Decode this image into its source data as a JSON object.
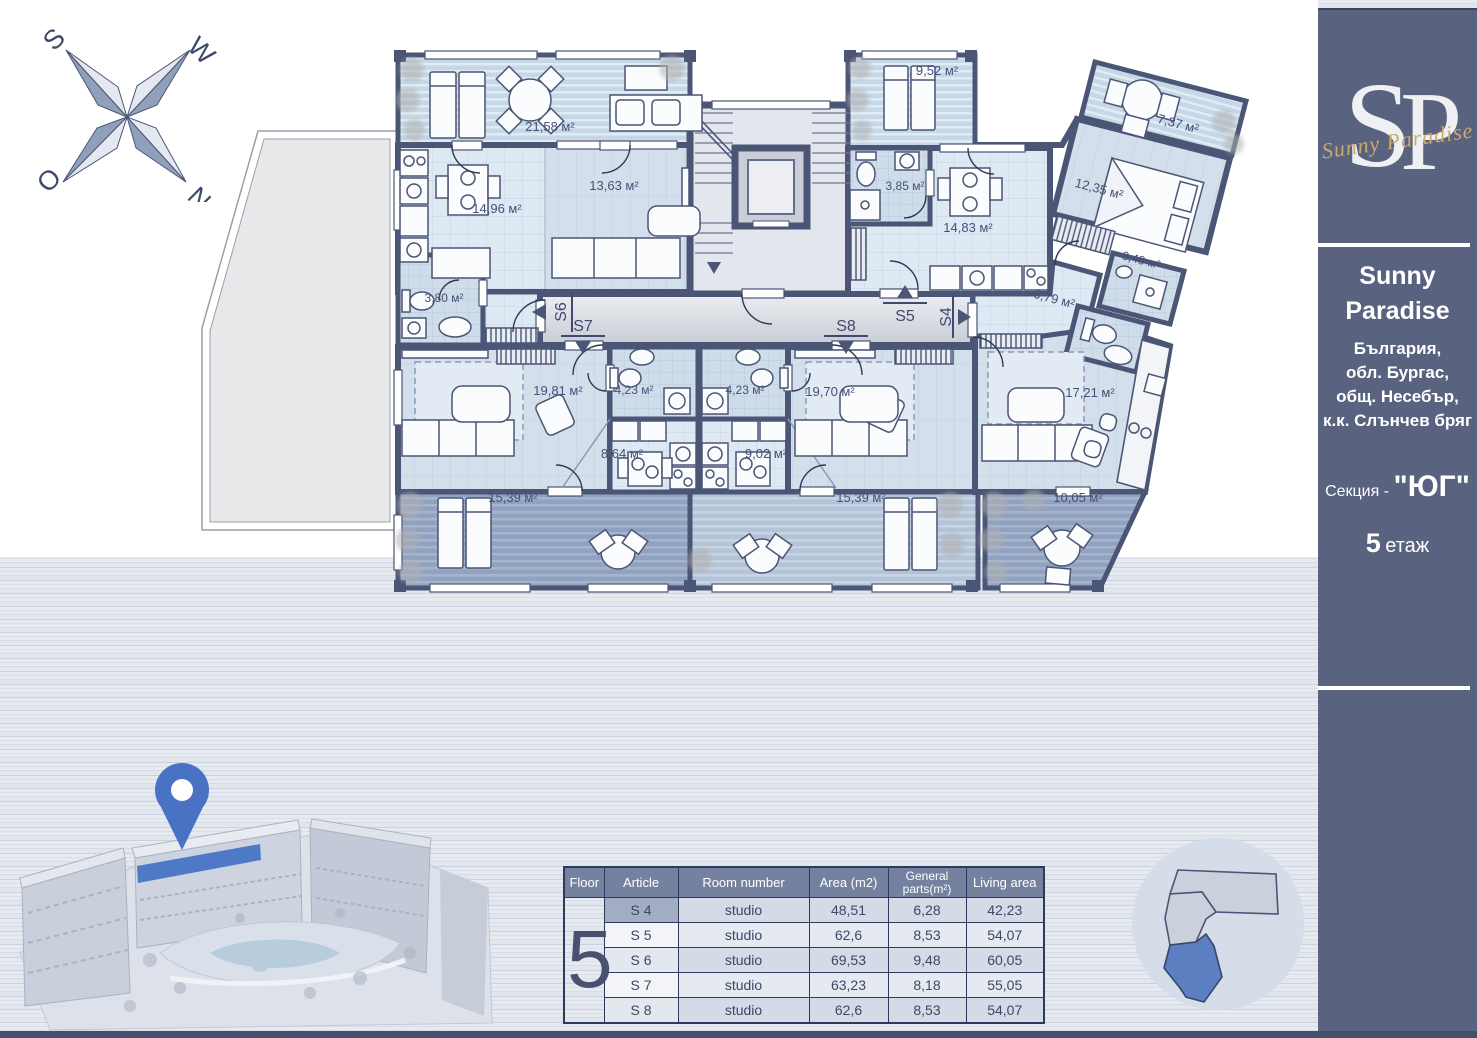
{
  "compass": {
    "s": "S",
    "w": "W",
    "o": "O",
    "n": "N"
  },
  "sidebar": {
    "logo": {
      "monogram_s": "S",
      "monogram_p": "P",
      "script": "Sunny Paradise"
    },
    "title_line1": "Sunny",
    "title_line2": "Paradise",
    "address_line1": "България,",
    "address_line2": "обл. Бургас,",
    "address_line3": "общ. Несебър,",
    "address_line4": "к.к. Слънчев бряг",
    "section_label": "Секция -",
    "section_value": "\"ЮГ\"",
    "floor_number": "5",
    "floor_word": "етаж"
  },
  "floorplan": {
    "rooms": {
      "terrace_s6": "21,58 м²",
      "kitchen_living_s6": "14,96 м²",
      "room_s6": "13,63 м²",
      "bath_s6": "3,80 м²",
      "terrace_s5": "9,52 м²",
      "bath_s5": "3,85 м²",
      "living_s5": "14,83 м²",
      "terrace_s4_top": "7,37 м²",
      "bedroom_s4": "12,35 м²",
      "bath_s4": "3,48 м²",
      "hall_s4": "6,79 м²",
      "living_s7": "19,81 м²",
      "bath_s7": "4,23 м²",
      "bath_s8": "4,23 м²",
      "living_s8": "19,70 м²",
      "kitchen_s7": "8,64 м²",
      "kitchen_s8": "9,02 м²",
      "living_s4": "17,21 м²",
      "terrace_s7": "15,39 м²",
      "terrace_s8": "15,39 м²",
      "terrace_s4_bottom": "10,05 м²"
    },
    "units": {
      "s4": "S4",
      "s5": "S5",
      "s6": "S6",
      "s7": "S7",
      "s8": "S8"
    }
  },
  "table": {
    "floor_header": "Floor",
    "floor_value": "5",
    "headers": [
      "Article",
      "Room number",
      "Area (m2)",
      "General parts(m²)",
      "Living area"
    ],
    "rows": [
      {
        "article": "S 4",
        "room": "studio",
        "area": "48,51",
        "general": "6,28",
        "living": "42,23"
      },
      {
        "article": "S 5",
        "room": "studio",
        "area": "62,6",
        "general": "8,53",
        "living": "54,07"
      },
      {
        "article": "S 6",
        "room": "studio",
        "area": "69,53",
        "general": "9,48",
        "living": "60,05"
      },
      {
        "article": "S 7",
        "room": "studio",
        "area": "63,23",
        "general": "8,18",
        "living": "55,05"
      },
      {
        "article": "S 8",
        "room": "studio",
        "area": "62,6",
        "general": "8,53",
        "living": "54,07"
      }
    ]
  },
  "colors": {
    "accent_blue": "#4e79c7",
    "sidebar": "#59627e",
    "wall": "#4b5575"
  }
}
